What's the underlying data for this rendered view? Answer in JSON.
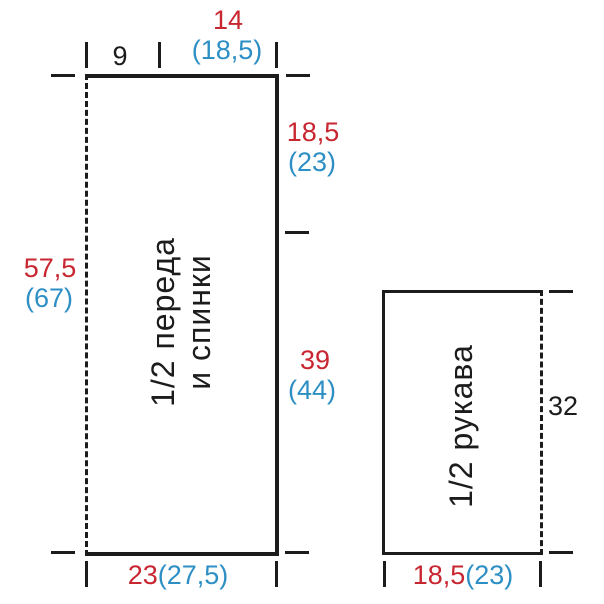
{
  "colors": {
    "size_primary": "#c82630",
    "size_alt": "#2d8fc4",
    "line": "#1c1c1c"
  },
  "pieces": {
    "front_back": {
      "label_lines": [
        "1/2 переда",
        "и спинки"
      ],
      "top_left_width": "9",
      "top_right_width": "14",
      "top_right_width_alt": "(18,5)",
      "side_upper": "18,5",
      "side_upper_alt": "(23)",
      "side_lower": "39",
      "side_lower_alt": "(44)",
      "length": "57,5",
      "length_alt": "(67)",
      "bottom_width": "23",
      "bottom_width_alt": "(27,5)"
    },
    "sleeve": {
      "label": "1/2 рукава",
      "side_length": "32",
      "bottom_width": "18,5",
      "bottom_width_alt": "(23)"
    }
  }
}
